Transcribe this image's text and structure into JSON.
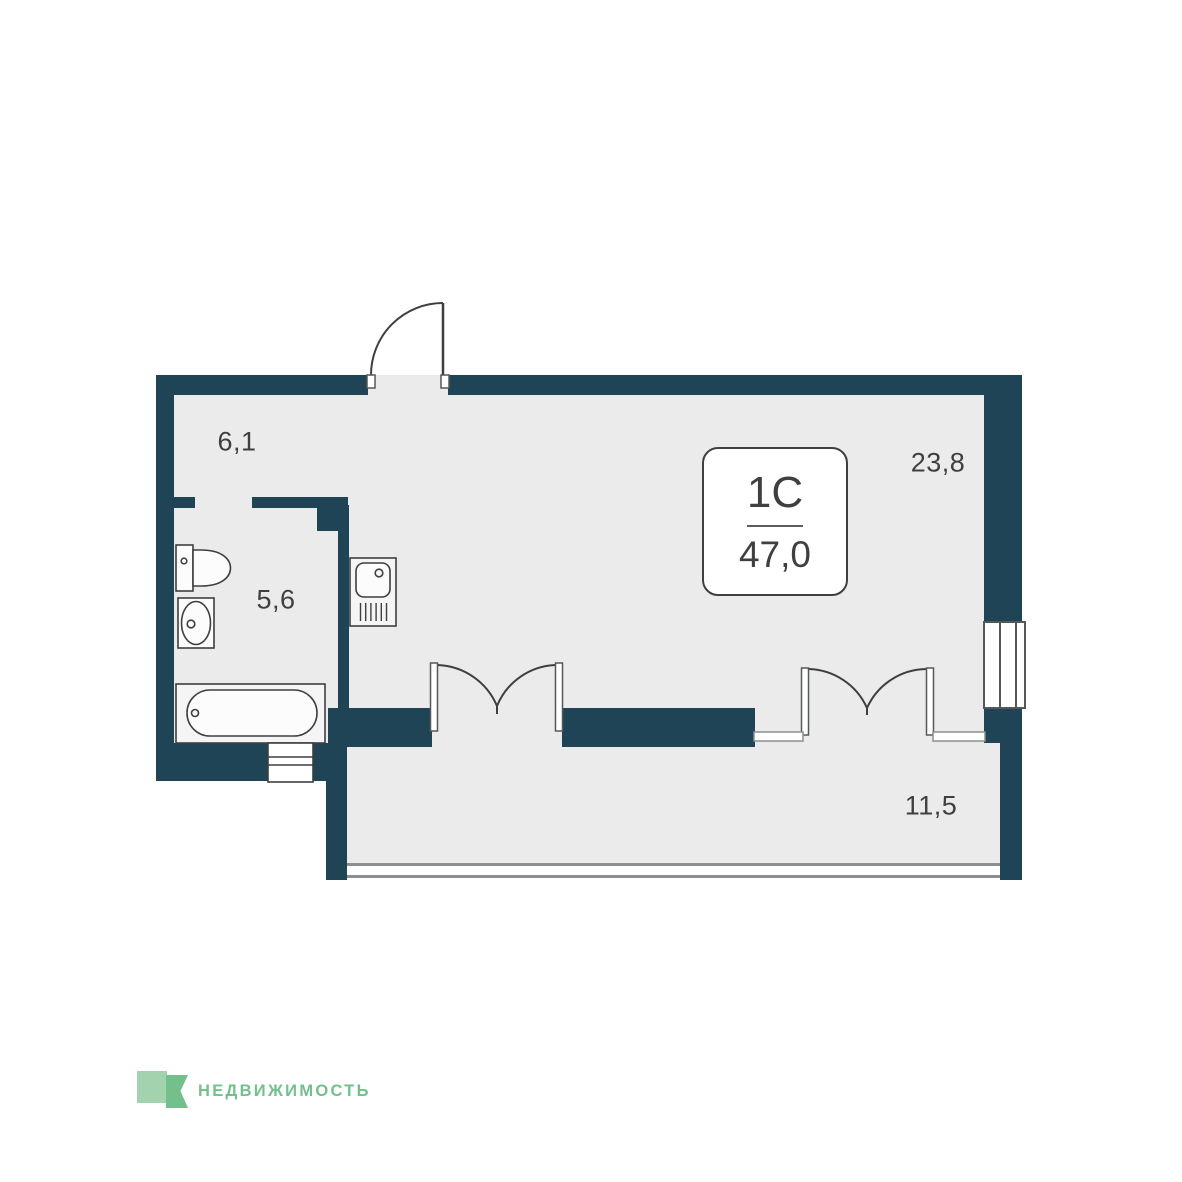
{
  "floor_plan": {
    "unit_card": {
      "type": "1C",
      "area": "47,0"
    },
    "rooms": [
      {
        "name": "hallway",
        "area_label": "6,1"
      },
      {
        "name": "bathroom",
        "area_label": "5,6"
      },
      {
        "name": "living-room",
        "area_label": "23,8"
      },
      {
        "name": "bedroom",
        "area_label": "11,5"
      }
    ],
    "fixtures": [
      {
        "name": "toilet"
      },
      {
        "name": "wash-basin"
      },
      {
        "name": "bathtub"
      },
      {
        "name": "kitchen-sink"
      },
      {
        "name": "duct-shaft"
      }
    ],
    "openings": [
      {
        "name": "entrance-door"
      },
      {
        "name": "double-door-left"
      },
      {
        "name": "double-door-right"
      },
      {
        "name": "window-right"
      },
      {
        "name": "window-bottom"
      }
    ]
  },
  "branding": {
    "logo_text": "НЕДВИЖИМОСТЬ",
    "logo_icon": "green-square-ribbon-icon"
  },
  "colors": {
    "wall": "#1e4456",
    "floor": "#ebebeb",
    "line": "#3f3f3f",
    "frame_line": "#55585a",
    "light_line": "#8b8e90",
    "fixture_fill": "#fcfcfc",
    "unit_fill": "#f5f5f5",
    "white": "#ffffff",
    "text": "#3f3f3f",
    "logo_green": "#74c08c",
    "logo_green_light": "#a3d2af"
  }
}
